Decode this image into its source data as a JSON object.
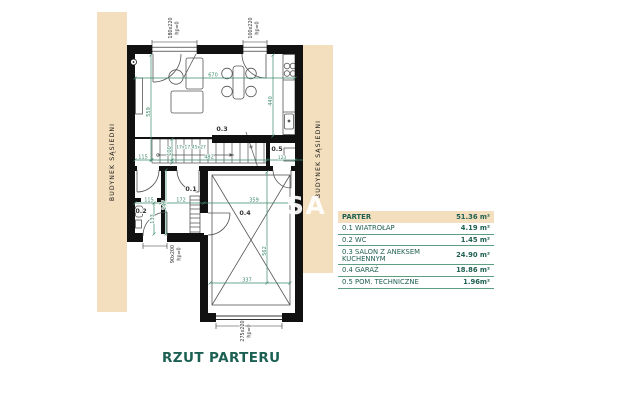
{
  "title": "RZUT PARTERU",
  "watermark": "SA",
  "neighbors": {
    "left": "BUDYNEK SĄSIEDNI",
    "right": "BUDYNEK SĄSIEDNI"
  },
  "rooms": {
    "r01": "0.1",
    "r02": "0.2",
    "r03": "0.3",
    "r04": "0.4",
    "r05": "0.5"
  },
  "dims": {
    "d670": "670",
    "d559": "559",
    "d440": "440",
    "d115_top": "115",
    "d100": "100",
    "d482": "482",
    "d123": "123",
    "stairs_spec": "17x17,45x27",
    "marker": "*",
    "d115_mid": "115",
    "d247": "247",
    "d172": "172",
    "d359": "359",
    "d133": "133",
    "d562": "562",
    "d337": "337"
  },
  "openings": {
    "win180": "180x220",
    "win180_hp": "hp=0",
    "win100": "100x220",
    "win100_hp": "hp=0",
    "door90": "90x200",
    "door90_hp": "hp=0",
    "garage275": "275x220",
    "garage275_hp": "hp=0"
  },
  "legend": {
    "header": {
      "label": "PARTER",
      "area": "51.36 m²"
    },
    "rows": [
      {
        "label": "0.1 WIATROŁAP",
        "area": "4.19 m²"
      },
      {
        "label": "0.2 WC",
        "area": "1.45 m²"
      },
      {
        "label": "0.3 SALON Z ANEKSEM KUCHENNYM",
        "area": "24.90 m²"
      },
      {
        "label": "0.4 GARAŻ",
        "area": "18.86 m²"
      },
      {
        "label": "0.5 POM. TECHNICZNE",
        "area": "1.96m²"
      }
    ]
  },
  "colors": {
    "beige": "#f3dfbd",
    "dim_green": "#3e8a6c",
    "heading_teal": "#1c6053",
    "wall_black": "#111111"
  }
}
